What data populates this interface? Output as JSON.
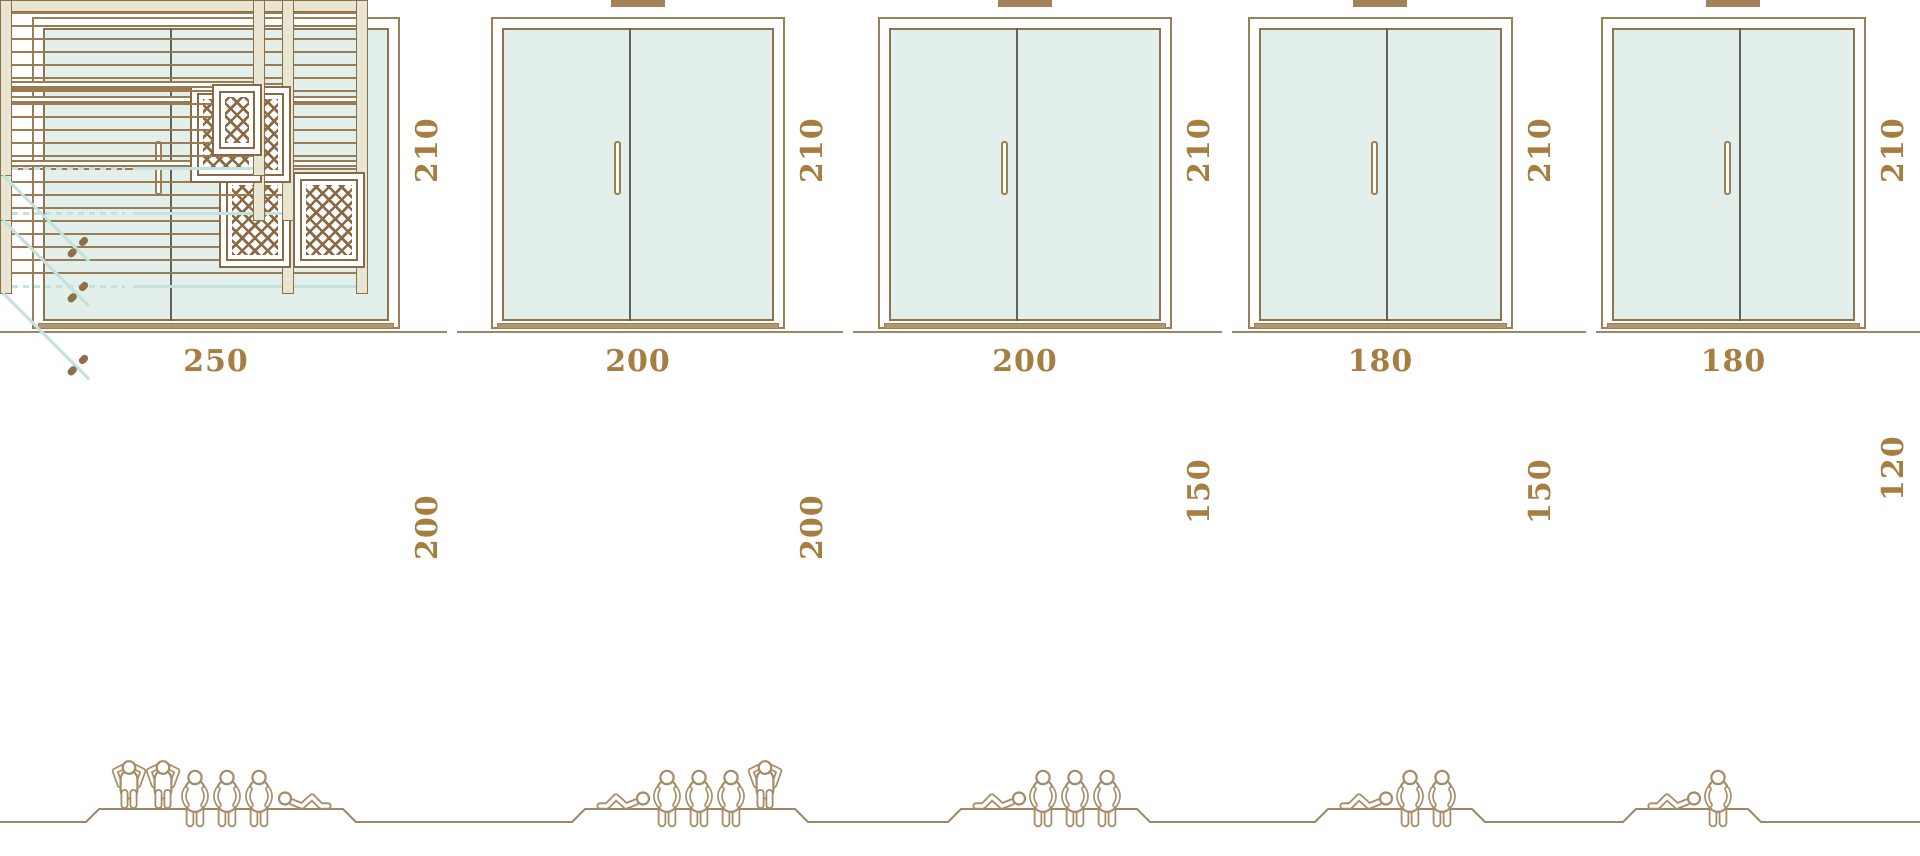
{
  "diagram": {
    "description": "Five sauna size options: front door elevations with height, floor plans with width and depth, and capacity figures",
    "unit_labels_shown": false
  },
  "colors": {
    "frame": "#9a8057",
    "glass": "#e2efeb",
    "glass_border": "#8d7350",
    "divider": "#66625a",
    "teal": "#c3e2dd",
    "dim_text": "#a57e40",
    "sill": "#b3976c",
    "wall_fill": "#e8e5d2",
    "wall_border": "#8a7049",
    "slat": "#9b7b52",
    "hatch": "#8a6a45",
    "figure": "#a48d66",
    "ground": "#9e8766",
    "tab": "#a3815a",
    "handle": "#8f6f48"
  },
  "saunas": [
    {
      "width_label": "250",
      "depth_label": "200",
      "height_label": "210",
      "width_cm": 250,
      "depth_cm": 200,
      "height_cm": 210,
      "capacity": {
        "standing": 2,
        "seated": 3,
        "reclining": 1,
        "total": 6
      },
      "figures": [
        "standing",
        "standing",
        "seated",
        "seated",
        "seated",
        "reclining-right"
      ],
      "heater_position": "bottom-right"
    },
    {
      "width_label": "200",
      "depth_label": "200",
      "height_label": "210",
      "width_cm": 200,
      "depth_cm": 200,
      "height_cm": 210,
      "capacity": {
        "standing": 1,
        "seated": 3,
        "reclining": 1,
        "total": 5
      },
      "figures": [
        "reclining-left",
        "seated",
        "seated",
        "seated",
        "standing"
      ],
      "heater_position": "bottom-right"
    },
    {
      "width_label": "200",
      "depth_label": "150",
      "height_label": "210",
      "width_cm": 200,
      "depth_cm": 150,
      "height_cm": 210,
      "capacity": {
        "standing": 0,
        "seated": 3,
        "reclining": 1,
        "total": 4
      },
      "figures": [
        "reclining-left",
        "seated",
        "seated",
        "seated"
      ],
      "heater_position": "middle-right"
    },
    {
      "width_label": "180",
      "depth_label": "150",
      "height_label": "210",
      "width_cm": 180,
      "depth_cm": 150,
      "height_cm": 210,
      "capacity": {
        "standing": 0,
        "seated": 2,
        "reclining": 1,
        "total": 3
      },
      "figures": [
        "reclining-left",
        "seated",
        "seated"
      ],
      "heater_position": "middle-right"
    },
    {
      "width_label": "180",
      "depth_label": "120",
      "height_label": "210",
      "width_cm": 180,
      "depth_cm": 120,
      "height_cm": 210,
      "capacity": {
        "standing": 0,
        "seated": 1,
        "reclining": 1,
        "total": 2
      },
      "figures": [
        "reclining-left",
        "seated"
      ],
      "heater_position": "middle-right"
    }
  ]
}
